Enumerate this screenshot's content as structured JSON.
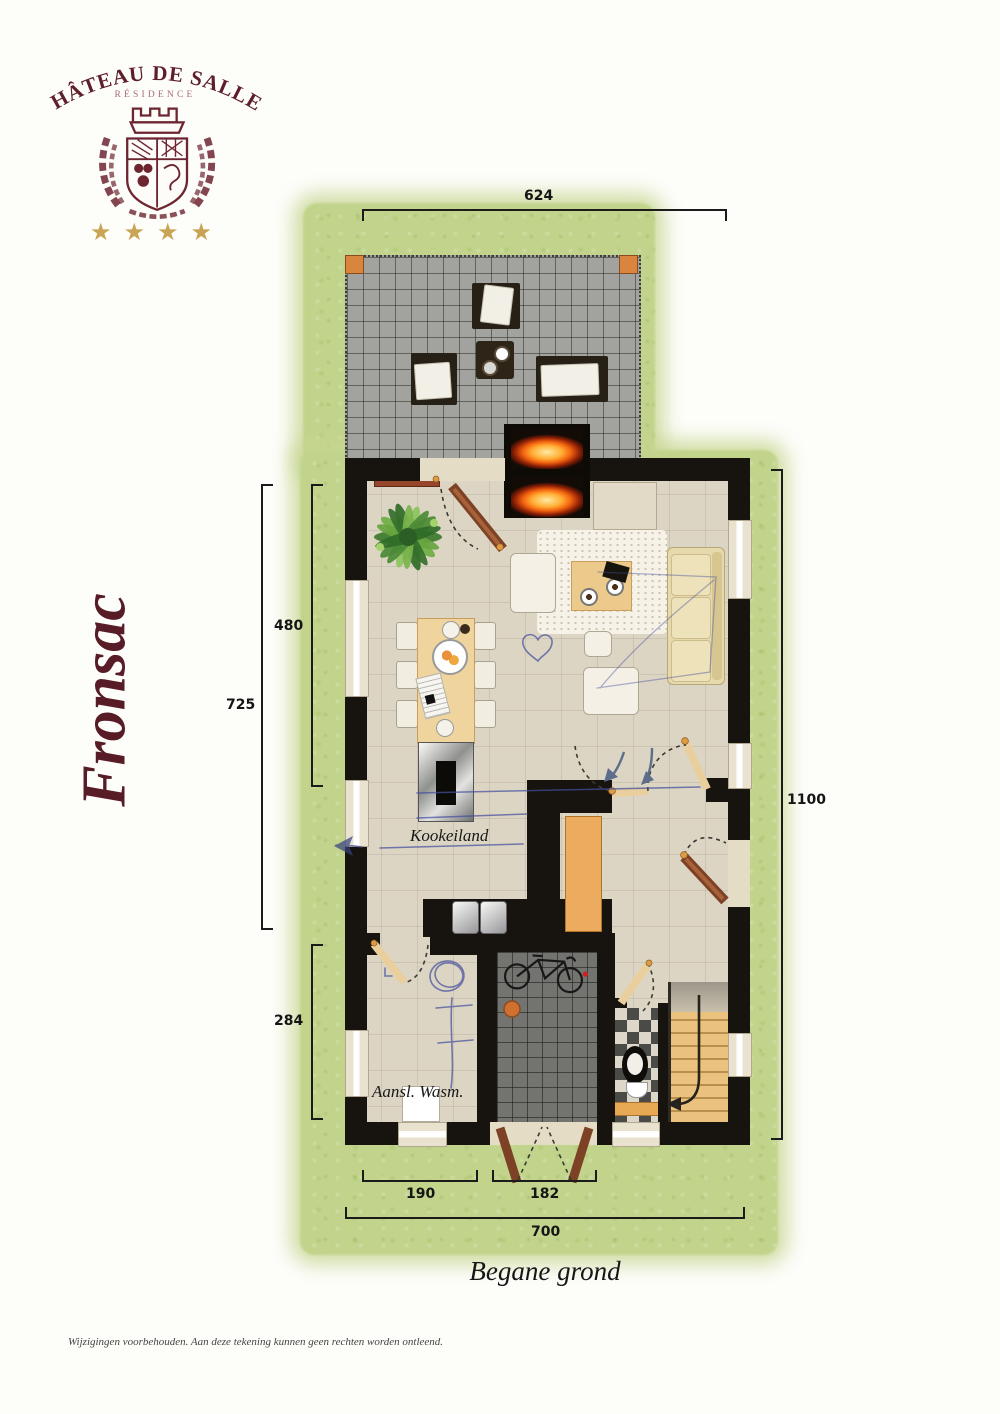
{
  "brand": {
    "name_arc": "CHÂTEAU DE SALLES",
    "subtitle": "RÉSIDENCE",
    "stars": "★ ★ ★ ★"
  },
  "model_name": "Fronsac",
  "floor_plan": {
    "title": "Begane grond",
    "room_labels": {
      "kitchen_island": "Kookeiland",
      "washer_connection": "Aansl. Wasm."
    },
    "dimensions": {
      "terrace_width": "624",
      "living_depth": "480",
      "left_total": "725",
      "utility_depth": "284",
      "house_depth": "1100",
      "bottom_left": "190",
      "entry_width": "182",
      "house_width": "700"
    }
  },
  "footer": {
    "disclaimer": "Wijzigingen voorbehouden. Aan deze tekening kunnen geen rechten worden ontleend."
  },
  "palette": {
    "maroon": "#5d1f2a",
    "gold": "#c9a455",
    "grass": "#c2d48c",
    "wall": "#17130e",
    "floor": "#ddd5c3",
    "terrace": "#a2a29e",
    "wood_light": "#e9cf9e",
    "door_brown": "#8a4b2b",
    "ink_blue": "#3f4da0"
  }
}
